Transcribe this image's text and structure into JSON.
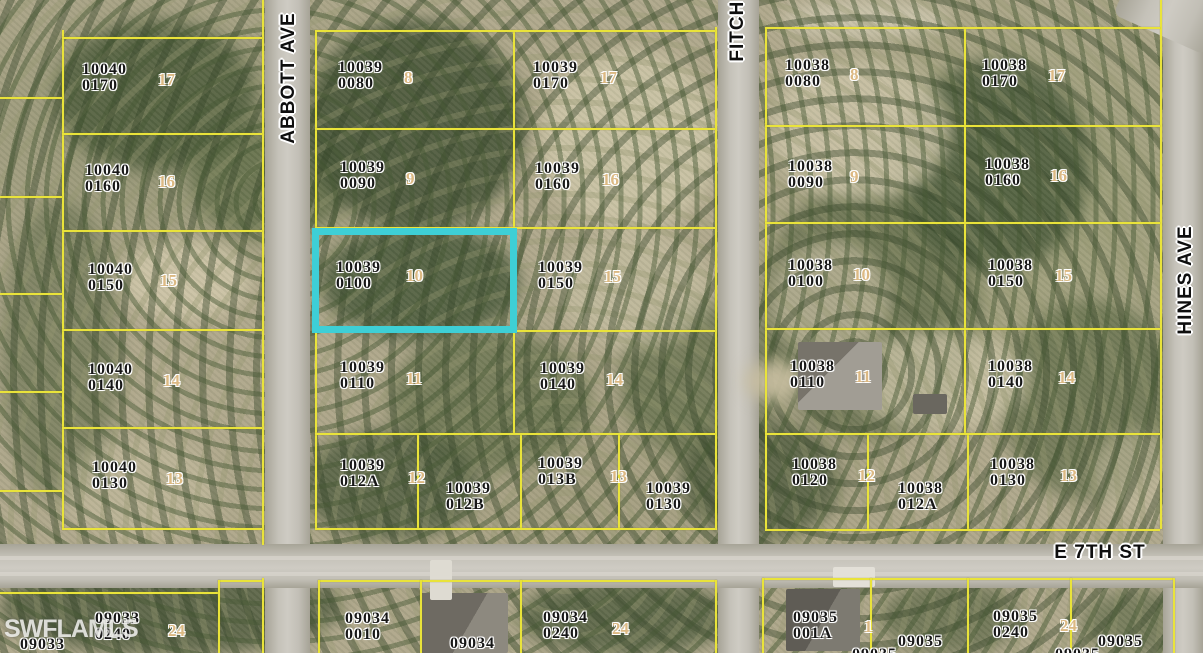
{
  "map": {
    "watermark": "SWFLAMLS",
    "streets": {
      "abbott": "ABBOTT AVE",
      "fitch": "FITCH AVE",
      "hines": "HINES AVE",
      "e7th": "E 7TH ST"
    },
    "highlighted_parcel": {
      "id": "10039 0100",
      "lot": "10",
      "outline": "#3ecfd6"
    },
    "colors": {
      "boundary": "#e9e33a",
      "highlight": "#3ecfd6",
      "lot_number": "#dcb983",
      "parcel_text": "#161616",
      "road": "#c5c2b9"
    },
    "parcels": [
      {
        "line1": "10040",
        "line2": "0170"
      },
      {
        "line1": "10040",
        "line2": "0160"
      },
      {
        "line1": "10040",
        "line2": "0150"
      },
      {
        "line1": "10040",
        "line2": "0140"
      },
      {
        "line1": "10040",
        "line2": "0130"
      },
      {
        "line1": "10039",
        "line2": "0080"
      },
      {
        "line1": "10039",
        "line2": "0170"
      },
      {
        "line1": "10039",
        "line2": "0090"
      },
      {
        "line1": "10039",
        "line2": "0160"
      },
      {
        "line1": "10039",
        "line2": "0100"
      },
      {
        "line1": "10039",
        "line2": "0150"
      },
      {
        "line1": "10039",
        "line2": "0110"
      },
      {
        "line1": "10039",
        "line2": "0140"
      },
      {
        "line1": "10039",
        "line2": "012A"
      },
      {
        "line1": "10039",
        "line2": "012B"
      },
      {
        "line1": "10039",
        "line2": "013B"
      },
      {
        "line1": "10039",
        "line2": "0130"
      },
      {
        "line1": "10038",
        "line2": "0080"
      },
      {
        "line1": "10038",
        "line2": "0170"
      },
      {
        "line1": "10038",
        "line2": "0090"
      },
      {
        "line1": "10038",
        "line2": "0160"
      },
      {
        "line1": "10038",
        "line2": "0100"
      },
      {
        "line1": "10038",
        "line2": "0150"
      },
      {
        "line1": "10038",
        "line2": "0110"
      },
      {
        "line1": "10038",
        "line2": "0140"
      },
      {
        "line1": "10038",
        "line2": "0120"
      },
      {
        "line1": "10038",
        "line2": "012A"
      },
      {
        "line1": "10038",
        "line2": "0130"
      },
      {
        "line1": "09033",
        "line2": "0240"
      },
      {
        "line1": "09034",
        "line2": "0010"
      },
      {
        "line1": "09034",
        "line2": "0240"
      },
      {
        "line1": "09035",
        "line2": "001A"
      },
      {
        "line1": "09035",
        "line2": "0240"
      }
    ],
    "singles": [
      "09034",
      "09035",
      "09035",
      "09033",
      "09035",
      "09035"
    ],
    "lots": [
      "17",
      "16",
      "15",
      "14",
      "13",
      "8",
      "17",
      "9",
      "16",
      "10",
      "15",
      "11",
      "14",
      "12",
      "13",
      "8",
      "17",
      "9",
      "16",
      "10",
      "15",
      "11",
      "14",
      "12",
      "13",
      "24",
      "24",
      "1",
      "24"
    ]
  }
}
